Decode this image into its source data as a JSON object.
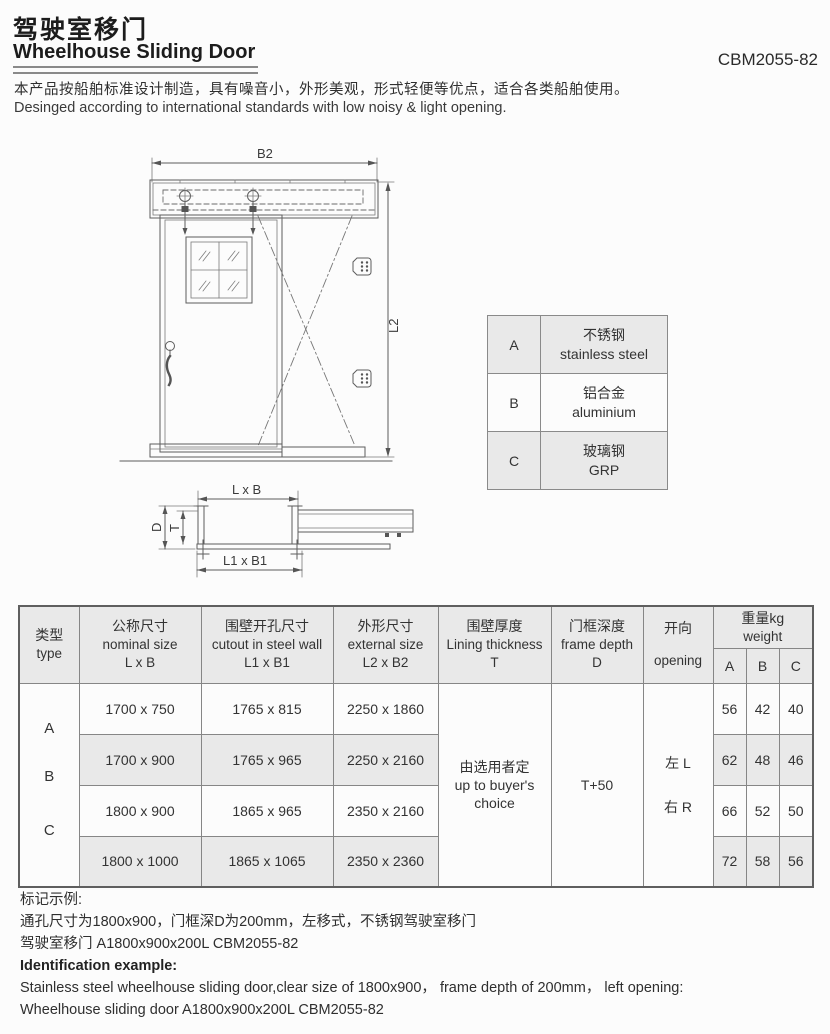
{
  "header": {
    "title_zh": "驾驶室移门",
    "title_en": "Wheelhouse Sliding Door",
    "doc_code": "CBM2055-82"
  },
  "intro": {
    "zh": "本产品按船舶标准设计制造，具有噪音小，外形美观，形式轻便等优点，适合各类船舶使用。",
    "en": "Desinged according to international standards with low noisy & light opening."
  },
  "drawing": {
    "labels": {
      "b2": "B2",
      "l2": "L2",
      "lxb": "L x B",
      "l1xb1": "L1 x B1",
      "d": "D",
      "t": "T"
    }
  },
  "materials": {
    "rows": [
      {
        "key": "A",
        "zh": "不锈钢",
        "en": "stainless steel"
      },
      {
        "key": "B",
        "zh": "铝合金",
        "en": "aluminium"
      },
      {
        "key": "C",
        "zh": "玻璃钢",
        "en": "GRP"
      }
    ]
  },
  "spec_table": {
    "headers": {
      "type": {
        "zh": "类型",
        "en": "type"
      },
      "nominal": {
        "zh": "公称尺寸",
        "en": "nominal size",
        "sub": "L x B"
      },
      "cutout": {
        "zh": "围壁开孔尺寸",
        "en": "cutout in steel wall",
        "sub": "L1 x B1"
      },
      "external": {
        "zh": "外形尺寸",
        "en": "external size",
        "sub": "L2 x B2"
      },
      "lining": {
        "zh": "围壁厚度",
        "en": "Lining thickness",
        "sub": "T"
      },
      "frame": {
        "zh": "门框深度",
        "en": "frame depth",
        "sub": "D"
      },
      "opening": {
        "zh": "开向",
        "en": "opening"
      },
      "weight": {
        "zh": "重量kg",
        "en": "weight",
        "col_a": "A",
        "col_b": "B",
        "col_c": "C"
      }
    },
    "type_letters": {
      "a": "A",
      "b": "B",
      "c": "C"
    },
    "rows": [
      {
        "nominal": "1700 x 750",
        "cutout": "1765 x 815",
        "external": "2250 x 1860",
        "wa": "56",
        "wb": "42",
        "wc": "40"
      },
      {
        "nominal": "1700 x 900",
        "cutout": "1765 x 965",
        "external": "2250 x 2160",
        "wa": "62",
        "wb": "48",
        "wc": "46"
      },
      {
        "nominal": "1800 x 900",
        "cutout": "1865 x 965",
        "external": "2350 x 2160",
        "wa": "66",
        "wb": "52",
        "wc": "50"
      },
      {
        "nominal": "1800 x 1000",
        "cutout": "1865 x 1065",
        "external": "2350 x 2360",
        "wa": "72",
        "wb": "58",
        "wc": "56"
      }
    ],
    "merged": {
      "lining_zh": "由选用者定",
      "lining_en1": "up to buyer's",
      "lining_en2": "choice",
      "frame_depth": "T+50",
      "opening_left": "左 L",
      "opening_right": "右 R"
    }
  },
  "footer": {
    "zh_heading": "标记示例:",
    "zh_line1": "通孔尺寸为1800x900，门框深D为200mm，左移式，不锈钢驾驶室移门",
    "zh_line2": "驾驶室移门 A1800x900x200L CBM2055-82",
    "en_heading": "Identification example:",
    "en_line1": "Stainless steel wheelhouse sliding door,clear size of 1800x900， frame depth of 200mm， left opening:",
    "en_line2": "Wheelhouse sliding door A1800x900x200L CBM2055-82"
  }
}
